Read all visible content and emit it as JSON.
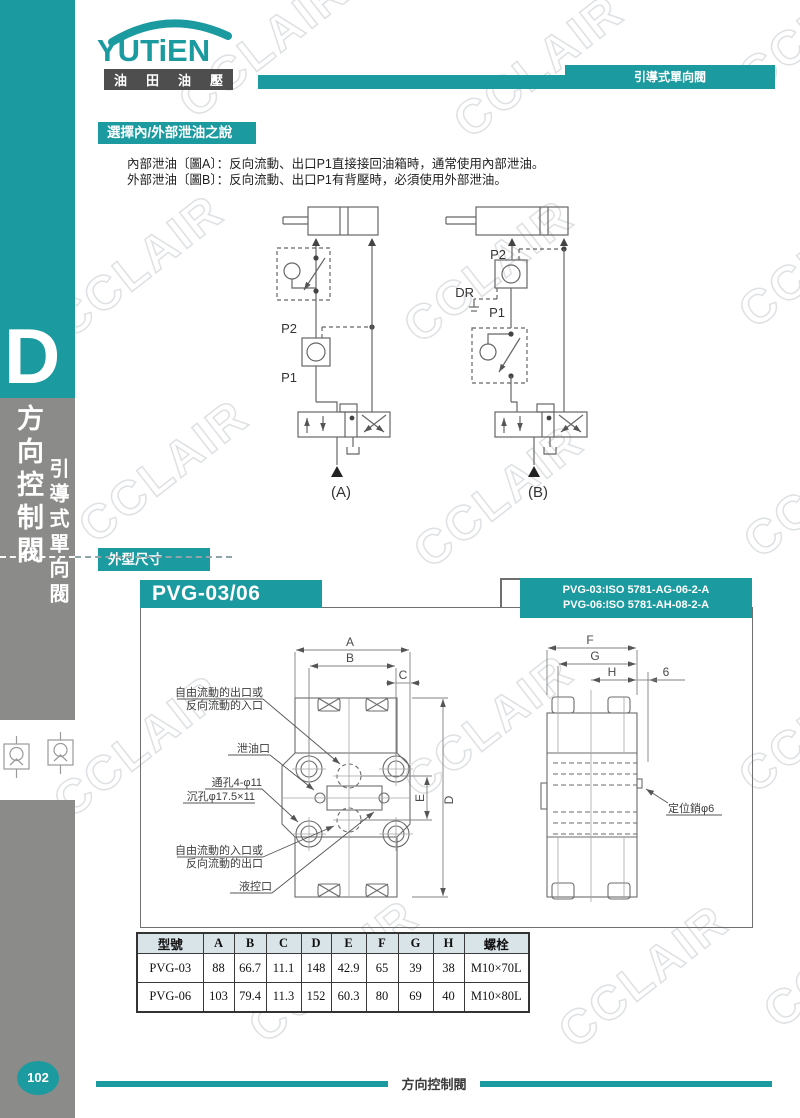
{
  "page": {
    "watermark": "CCLAIR"
  },
  "sidebar": {
    "letter": "D",
    "category": "方向控制閥",
    "subcategory": "引導式單向閥",
    "page_number": "102"
  },
  "header": {
    "logo": "YUTiEN",
    "logo_sub_1": "油",
    "logo_sub_2": "田",
    "logo_sub_3": "油",
    "logo_sub_4": "壓",
    "tab": "引導式單向閥"
  },
  "intro": {
    "title": "選擇內/外部泄油之說明：",
    "line1": "內部泄油〔圖A〕：反向流動、出口P1直接接回油箱時，通常使用內部泄油。",
    "line2": "外部泄油〔圖B〕：反向流動、出口P1有背壓時，必須使用外部泄油。"
  },
  "circuit": {
    "p2": "P2",
    "p1": "P1",
    "dr": "DR",
    "a_label": "(A)",
    "b_label": "(B)"
  },
  "dimensions": {
    "title": "外型尺寸",
    "model": "PVG-03/06",
    "iso1": "PVG-03:ISO 5781-AG-06-2-A",
    "iso2": "PVG-06:ISO 5781-AH-08-2-A",
    "labels": {
      "out_port1": "自由流動的出口或",
      "out_port2": "反向流動的入口",
      "drain": "泄油口",
      "hole1": "通孔4-φ11",
      "hole2": "沉孔φ17.5×11",
      "in_port1": "自由流動的入口或",
      "in_port2": "反向流動的出口",
      "pilot": "液控口",
      "pin": "定位銷φ6"
    },
    "dims": {
      "A": "A",
      "B": "B",
      "C": "C",
      "D": "D",
      "E": "E",
      "F": "F",
      "G": "G",
      "H": "H",
      "six": "6"
    }
  },
  "table": {
    "headers": [
      "型號",
      "A",
      "B",
      "C",
      "D",
      "E",
      "F",
      "G",
      "H",
      "螺栓"
    ],
    "rows": [
      [
        "PVG-03",
        "88",
        "66.7",
        "11.1",
        "148",
        "42.9",
        "65",
        "39",
        "38",
        "M10×70L"
      ],
      [
        "PVG-06",
        "103",
        "79.4",
        "11.3",
        "152",
        "60.3",
        "80",
        "69",
        "40",
        "M10×80L"
      ]
    ]
  },
  "footer": {
    "label": "方向控制閥"
  }
}
